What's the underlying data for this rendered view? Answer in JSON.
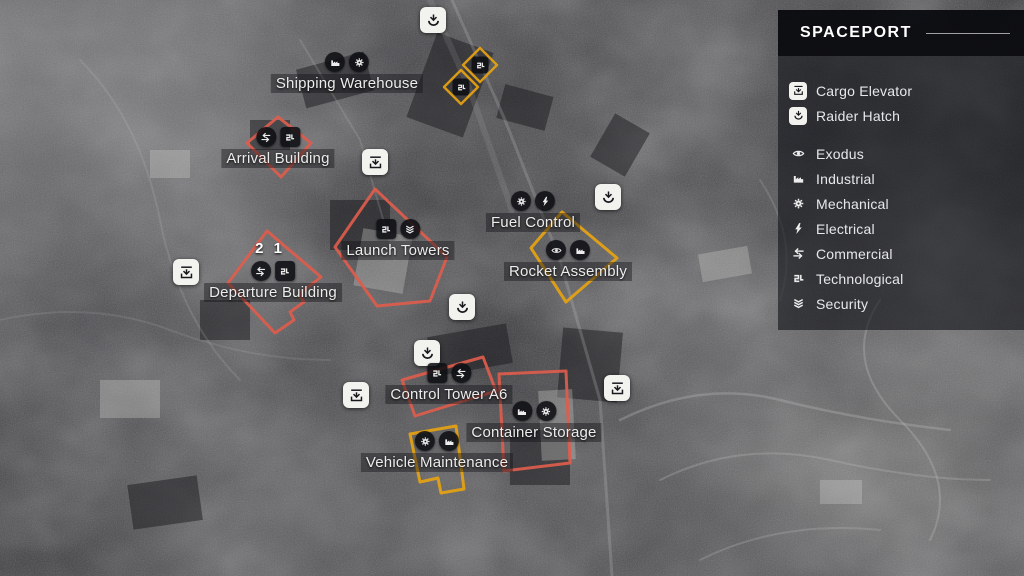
{
  "legend": {
    "title": "SPACEPORT",
    "hatch_items": [
      {
        "icon": "cargo-elevator-icon",
        "label": "Cargo Elevator"
      },
      {
        "icon": "raider-hatch-icon",
        "label": "Raider Hatch"
      }
    ],
    "category_items": [
      {
        "icon": "exodus-icon",
        "label": "Exodus"
      },
      {
        "icon": "industrial-icon",
        "label": "Industrial"
      },
      {
        "icon": "mechanical-icon",
        "label": "Mechanical"
      },
      {
        "icon": "electrical-icon",
        "label": "Electrical"
      },
      {
        "icon": "commercial-icon",
        "label": "Commercial"
      },
      {
        "icon": "technological-icon",
        "label": "Technological"
      },
      {
        "icon": "security-icon",
        "label": "Security"
      }
    ]
  },
  "map": {
    "locations": [
      {
        "name": "Shipping Warehouse",
        "badges": [
          "industrial",
          "mechanical"
        ],
        "outline": "none"
      },
      {
        "name": "Arrival Building",
        "badges": [
          "commercial",
          "technological"
        ],
        "outline": "red"
      },
      {
        "name": "Departure Building",
        "badges": [
          "commercial",
          "technological"
        ],
        "outline": "red",
        "counter": "2 1"
      },
      {
        "name": "Launch Towers",
        "badges": [
          "technological",
          "security"
        ],
        "outline": "red"
      },
      {
        "name": "Fuel Control",
        "badges": [
          "mechanical",
          "electrical"
        ],
        "outline": "none"
      },
      {
        "name": "Rocket Assembly",
        "badges": [
          "exodus",
          "industrial"
        ],
        "outline": "yellow"
      },
      {
        "name": "Control Tower A6",
        "badges": [
          "technological",
          "commercial"
        ],
        "outline": "red"
      },
      {
        "name": "Container Storage",
        "badges": [
          "industrial",
          "mechanical"
        ],
        "outline": "red"
      },
      {
        "name": "Vehicle Maintenance",
        "badges": [
          "mechanical",
          "industrial"
        ],
        "outline": "yellow"
      }
    ],
    "markers": {
      "raider_hatch_count": 4,
      "cargo_elevator_count": 4,
      "technological_pin_count": 2
    },
    "colors": {
      "zone_red": "#de5d4d",
      "zone_yellow": "#e7a312",
      "marker_bg": "#f2f2ef",
      "badge_bg": "#0e0f13"
    }
  }
}
